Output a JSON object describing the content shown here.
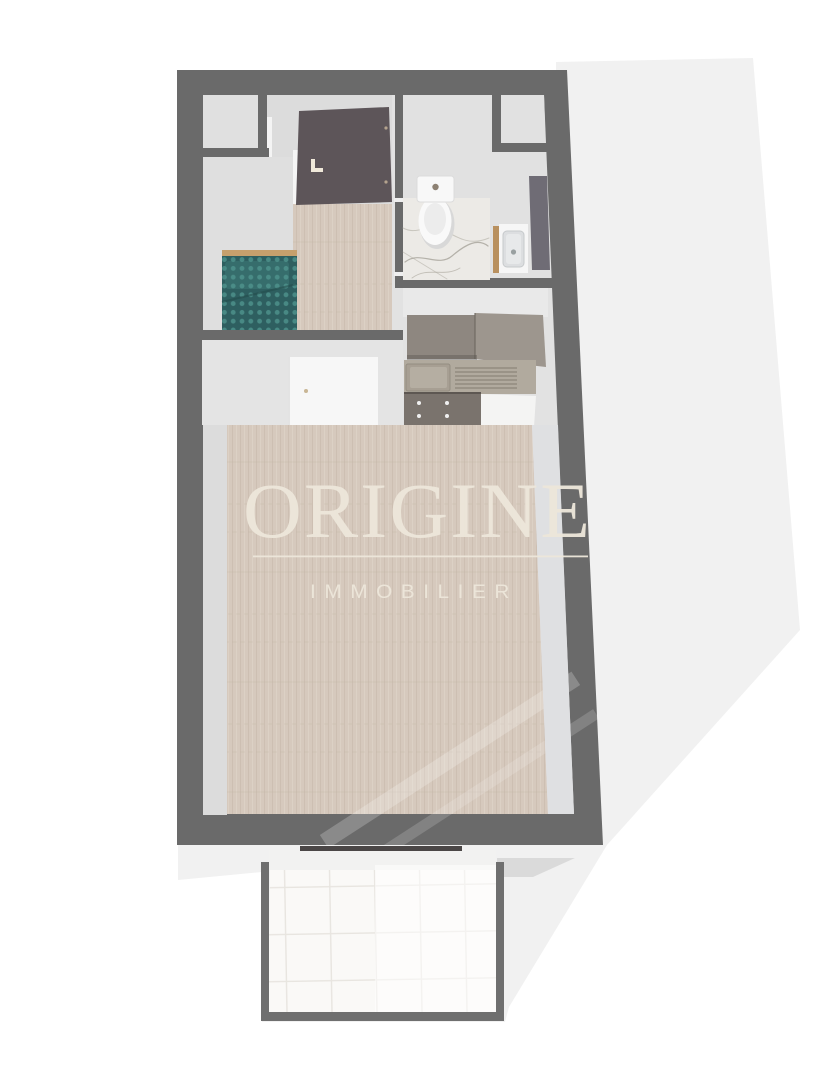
{
  "brand": {
    "name": "ORIGINE",
    "tagline": "IMMOBILIER"
  },
  "colors": {
    "page_background": "#ffffff",
    "ground": "#f1f1f1",
    "wall": "#6a6a6a",
    "terrace_wall": "#6f6f6f",
    "floor_gray": "#e2e2e2",
    "wall_face": "#e4e4e4",
    "wood": "#d6c9bd",
    "entry_door": "#5d5559",
    "open_door_white": "#f7f7f7",
    "bed_teal": "#2e5f60",
    "bed_dot": "#4f948d",
    "headboard_wood": "#c6a06d",
    "cabinet_upper": "#9d968e",
    "cabinet_lower": "#7a736d",
    "counter": "#b1aa9e",
    "marble": "#eceae6",
    "tile": "#faf9f7",
    "fixture": "#f9f9f9",
    "sink_wood": "#b8905f",
    "dark_panel": "#6f6c75",
    "watermark": "#ece6da"
  }
}
